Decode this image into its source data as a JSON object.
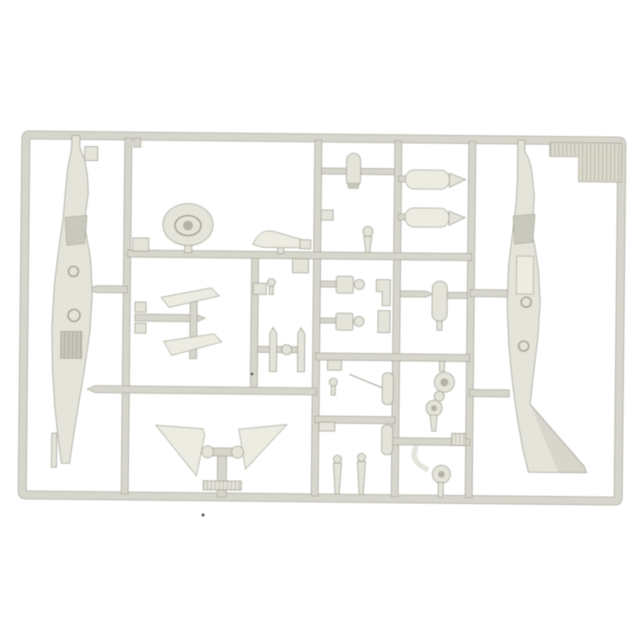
{
  "image": {
    "type": "product-photo",
    "subject": "Light grey plastic model kit sprue (injection-moulded runner frame) holding unassembled aircraft parts on a white background",
    "orientation_note": "rectangular sprue frame, slightly tilted clockwise, centered horizontally"
  },
  "colors": {
    "background": "#ffffff",
    "runner": "#d7d6cc",
    "runner_edge": "#adaca0",
    "part": "#e5e4da",
    "part_light": "#edece2",
    "part_edge": "#a3a295",
    "recess": "#c9c8bc",
    "hub": "#b3b2a6",
    "tag": "#dcdbcd",
    "speck": "#4f4d44"
  },
  "parts": [
    {
      "id": "frame",
      "label": "outer sprue frame"
    },
    {
      "id": "runners",
      "label": "internal runner bars"
    },
    {
      "id": "fuselage-left",
      "label": "left fuselage half, nose up"
    },
    {
      "id": "fuselage-right",
      "label": "right fuselage half with tail fin, nose up"
    },
    {
      "id": "nameplate-tag",
      "label": "ridged moulded nameplate tag, top right"
    },
    {
      "id": "dome",
      "label": "oval dome / wheel hub part"
    },
    {
      "id": "canopy",
      "label": "cockpit canopy part"
    },
    {
      "id": "stabilizer-set",
      "label": "two stabilizer panels on I-runner"
    },
    {
      "id": "missile-pair",
      "label": "two slim missile/pylon parts with bead"
    },
    {
      "id": "drop-tanks",
      "label": "two horizontal drop tanks with tips"
    },
    {
      "id": "bomb-top",
      "label": "vertical bomb on crossbar"
    },
    {
      "id": "pilot-figures",
      "label": "small standing figures"
    },
    {
      "id": "intake-boxes",
      "label": "small box parts with balls"
    },
    {
      "id": "pod",
      "label": "vertical pod part"
    },
    {
      "id": "wheel-chain",
      "label": "linked wheels"
    },
    {
      "id": "gear-parts",
      "label": "landing gear struts and wheel"
    },
    {
      "id": "bombs-side",
      "label": "bombs attached along runner"
    },
    {
      "id": "wing-set",
      "label": "two swept wing panels on T-runner"
    },
    {
      "id": "ribbed-blocks",
      "label": "small ribbed blocks"
    },
    {
      "id": "specks",
      "label": "tiny dark specks"
    }
  ]
}
